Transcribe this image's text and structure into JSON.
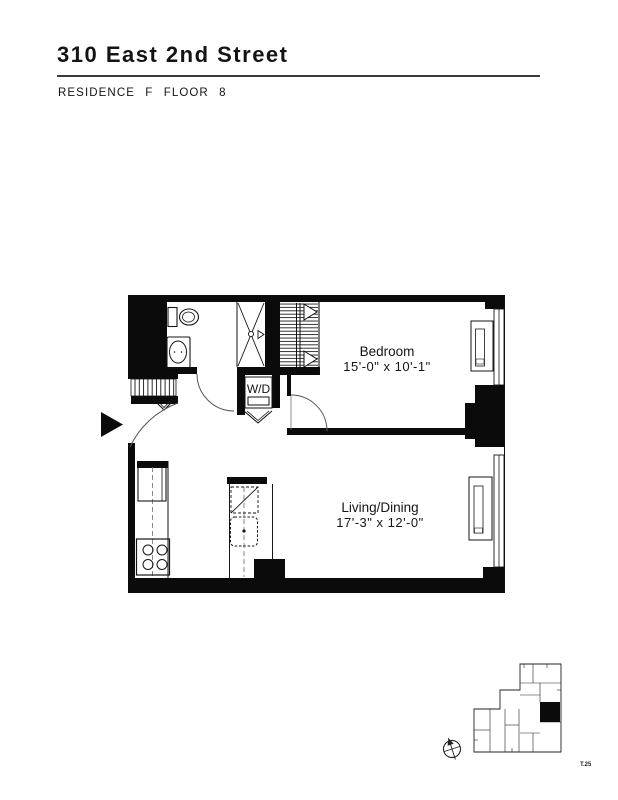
{
  "header": {
    "title": "310 East 2nd Street",
    "subtitle": "RESIDENCE F FLOOR 8"
  },
  "floor_plan": {
    "rooms": [
      {
        "name": "Bedroom",
        "dimensions": "15'-0\" x 10'-1\""
      },
      {
        "name": "Living/Dining",
        "dimensions": "17'-3\" x 12'-0\""
      }
    ],
    "washer_dryer_label": "W/D",
    "page_number": "T.25",
    "wall_color": "#0b0b0b",
    "line_color": "#1a1a1a"
  }
}
